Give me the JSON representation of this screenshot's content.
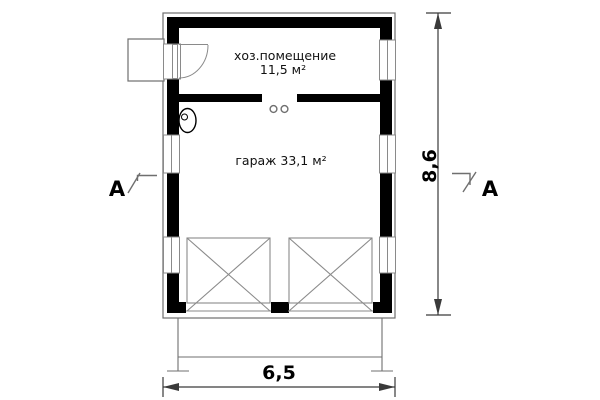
{
  "colors": {
    "wall": "#000000",
    "thin_line": "#6f6f6f",
    "frame_line": "#8a8a8a",
    "dim_line": "#3a3a3a",
    "background": "#ffffff"
  },
  "rooms": {
    "utility": {
      "name": "хоз.помещение",
      "area": "11,5 м²"
    },
    "garage": {
      "name": "гараж 33,1 м²"
    }
  },
  "dimensions": {
    "width": "6,5",
    "height": "8,6"
  },
  "sections": {
    "left": "A",
    "right": "A"
  }
}
